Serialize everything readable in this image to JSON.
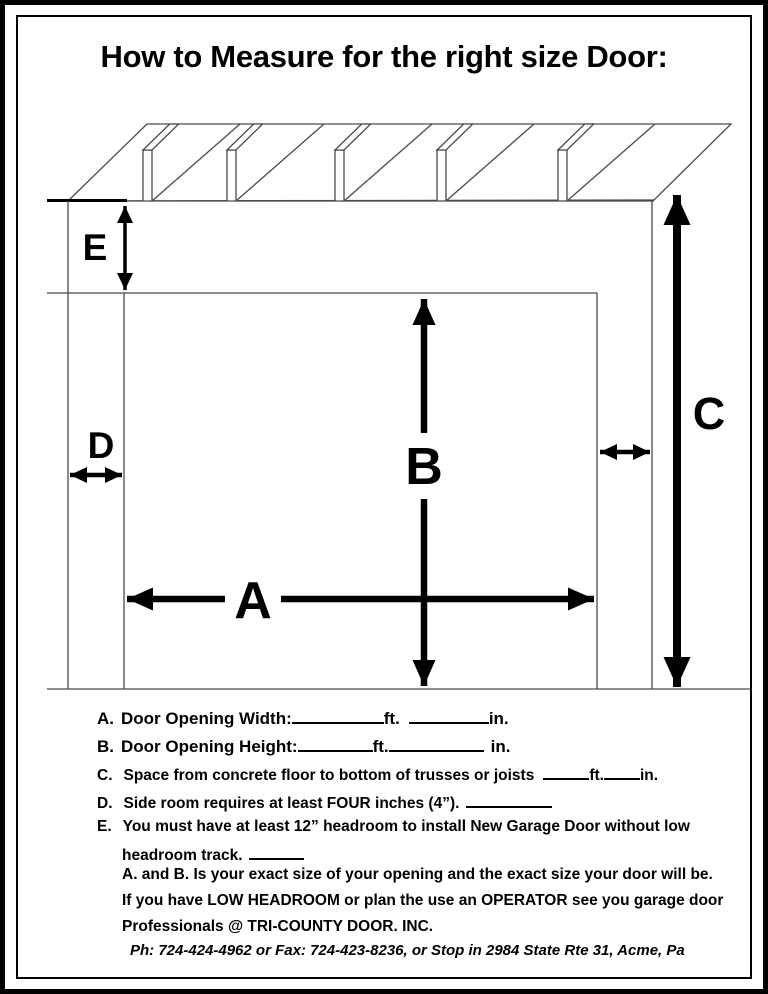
{
  "page": {
    "title": "How to Measure for the right size Door:"
  },
  "diagram": {
    "description": "garage-door-opening-measurement-drawing",
    "labels": {
      "a": "A",
      "b": "B",
      "c": "C",
      "d": "D",
      "e": "E"
    }
  },
  "instructions": {
    "a": {
      "label": "A.",
      "text": "Door Opening Width:",
      "unit_ft": "ft.",
      "unit_in": "in."
    },
    "b": {
      "label": "B.",
      "text": "Door Opening Height:",
      "unit_ft": "ft.",
      "unit_in": "in."
    },
    "c": {
      "label": "C.",
      "text": "Space from concrete floor to bottom of trusses or joists",
      "unit_ft": "ft.",
      "unit_in": "in."
    },
    "d": {
      "label": "D.",
      "text": "Side room requires at least FOUR inches (4”)."
    },
    "e": {
      "label": "E.",
      "line1": "You must have at least 12” headroom to install New Garage Door without low",
      "line2": "headroom track."
    },
    "note1": "A. and B. Is your exact size of your opening and the exact size your door will be.",
    "note2": "If you have LOW HEADROOM or plan the use an OPERATOR see you garage door",
    "note3": "Professionals @ TRI-COUNTY DOOR. INC.",
    "contact": "Ph: 724-424-4962 or Fax: 724-423-8236, or Stop in 2984 State Rte 31, Acme, Pa"
  },
  "colors": {
    "ink": "#000000",
    "thin_line": "#4a4a4a",
    "paper": "#ffffff"
  }
}
